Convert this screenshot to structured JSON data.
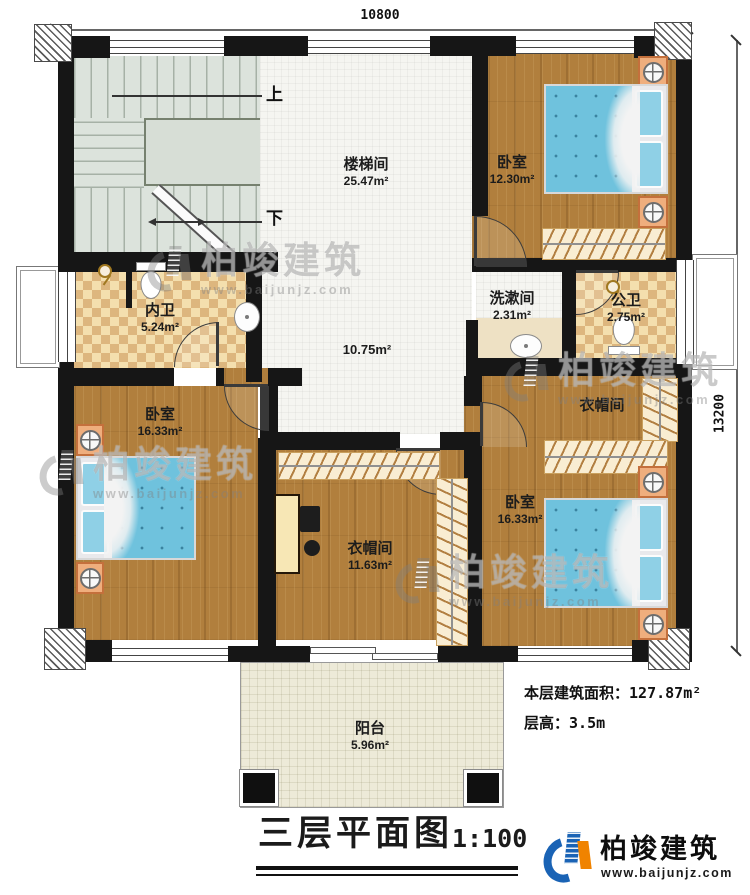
{
  "dimensions": {
    "top": "10800",
    "right": "13200"
  },
  "stairs": {
    "up": "上",
    "down": "下"
  },
  "rooms": {
    "stair_hall": {
      "name": "楼梯间",
      "area": "25.47m²"
    },
    "hall": {
      "area": "10.75m²"
    },
    "bedroom_top_right": {
      "name": "卧室",
      "area": "12.30m²"
    },
    "inner_bathroom": {
      "name": "内卫",
      "area": "5.24m²"
    },
    "washroom": {
      "name": "洗漱间",
      "area": "2.31m²"
    },
    "public_bathroom": {
      "name": "公卫",
      "area": "2.75m²"
    },
    "cloakroom_right": {
      "name": "衣帽间"
    },
    "bedroom_left": {
      "name": "卧室",
      "area": "16.33m²"
    },
    "cloakroom_bottom": {
      "name": "衣帽间",
      "area": "11.63m²"
    },
    "bedroom_bottom_right": {
      "name": "卧室",
      "area": "16.33m²"
    },
    "balcony": {
      "name": "阳台",
      "area": "5.96m²"
    }
  },
  "notes": {
    "floor_area_label": "本层建筑面积：",
    "floor_area_value": "127.87m²",
    "floor_height_label": "层高：",
    "floor_height_value": "3.5m"
  },
  "title_block": {
    "title": "三层平面图",
    "scale": "1:100"
  },
  "branding": {
    "name": "柏竣建筑",
    "url": "www.baijunjz.com"
  },
  "watermark": {
    "name": "柏竣建筑",
    "url": "www.baijunjz.com"
  },
  "colors": {
    "accent_blue": "#1a63b5",
    "accent_orange": "#f08300",
    "wood": "#b17f3d",
    "tile_light": "#f4dfae",
    "tile_dark": "#ddb67e",
    "bed_blue": "#6fc2dd"
  }
}
